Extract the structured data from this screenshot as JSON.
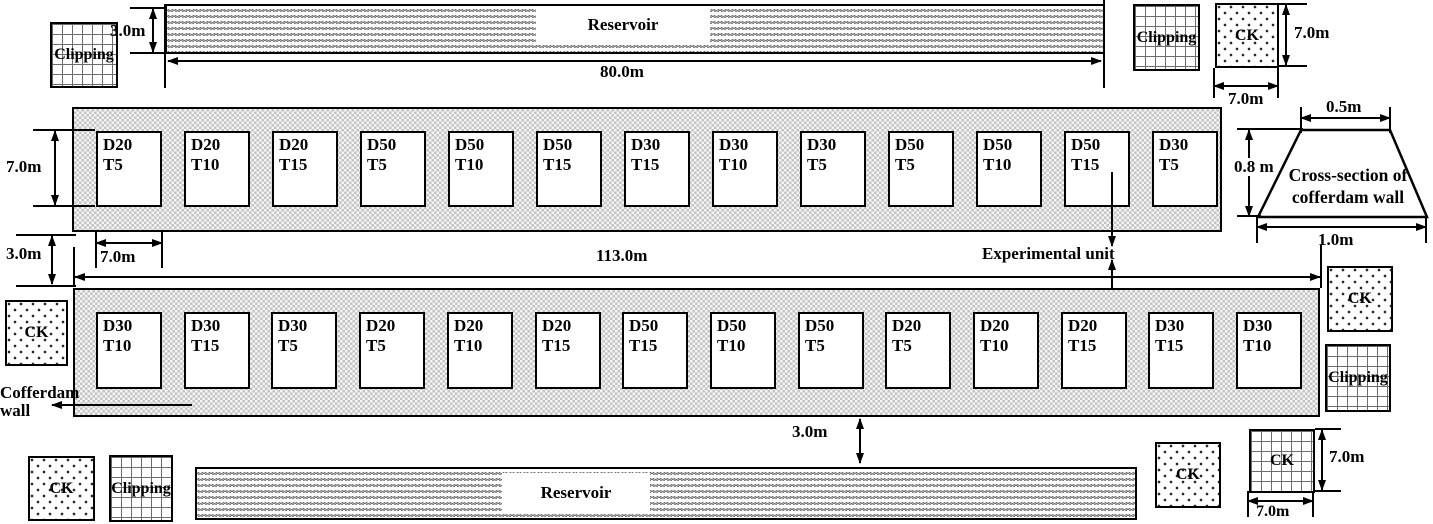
{
  "colors": {
    "ink": "#000000",
    "band_texture": "#c4c4c4",
    "reservoir_texture": "#6f6f6f"
  },
  "top": {
    "clipping_left": "Clipping",
    "dim_3m": "3.0m",
    "reservoir": "Reservoir",
    "dim_80m": "80.0m",
    "clipping_right": "Clipping",
    "ck_right": "CK",
    "dim_7m_v": "7.0m",
    "dim_7m_h": "7.0m"
  },
  "band1": {
    "dim_height": "7.0m",
    "dim_plot_width": "7.0m",
    "plots": [
      {
        "d": "D20",
        "t": "T5"
      },
      {
        "d": "D20",
        "t": "T10"
      },
      {
        "d": "D20",
        "t": "T15"
      },
      {
        "d": "D50",
        "t": "T5"
      },
      {
        "d": "D50",
        "t": "T10"
      },
      {
        "d": "D50",
        "t": "T15"
      },
      {
        "d": "D30",
        "t": "T15"
      },
      {
        "d": "D30",
        "t": "T10"
      },
      {
        "d": "D30",
        "t": "T5"
      },
      {
        "d": "D50",
        "t": "T5"
      },
      {
        "d": "D50",
        "t": "T10"
      },
      {
        "d": "D50",
        "t": "T15"
      },
      {
        "d": "D30",
        "t": "T5"
      }
    ]
  },
  "cross_section": {
    "dim_top": "0.5m",
    "dim_height": "0.8 m",
    "dim_bottom": "1.0m",
    "line1": "Cross-section of",
    "line2": "cofferdam wall"
  },
  "middle": {
    "dim_gap": "3.0m",
    "dim_length": "113.0m",
    "experimental_unit": "Experimental unit"
  },
  "band2": {
    "ck_left": "CK",
    "cofferdam_line1": "Cofferdam",
    "cofferdam_line2": "wall",
    "ck_right": "CK",
    "clipping_right": "Clipping",
    "plots": [
      {
        "d": "D30",
        "t": "T10"
      },
      {
        "d": "D30",
        "t": "T15"
      },
      {
        "d": "D30",
        "t": "T5"
      },
      {
        "d": "D20",
        "t": "T5"
      },
      {
        "d": "D20",
        "t": "T10"
      },
      {
        "d": "D20",
        "t": "T15"
      },
      {
        "d": "D50",
        "t": "T15"
      },
      {
        "d": "D50",
        "t": "T10"
      },
      {
        "d": "D50",
        "t": "T5"
      },
      {
        "d": "D20",
        "t": "T5"
      },
      {
        "d": "D20",
        "t": "T10"
      },
      {
        "d": "D20",
        "t": "T15"
      },
      {
        "d": "D30",
        "t": "T15"
      },
      {
        "d": "D30",
        "t": "T10"
      }
    ]
  },
  "bottom": {
    "dim_gap": "3.0m",
    "reservoir": "Reservoir",
    "ck_left": "CK",
    "clipping_left": "Clipping",
    "ck_right": "CK",
    "ck_far_right": "CK",
    "dim_7m_v": "7.0m",
    "dim_7m_h": "7.0m"
  }
}
